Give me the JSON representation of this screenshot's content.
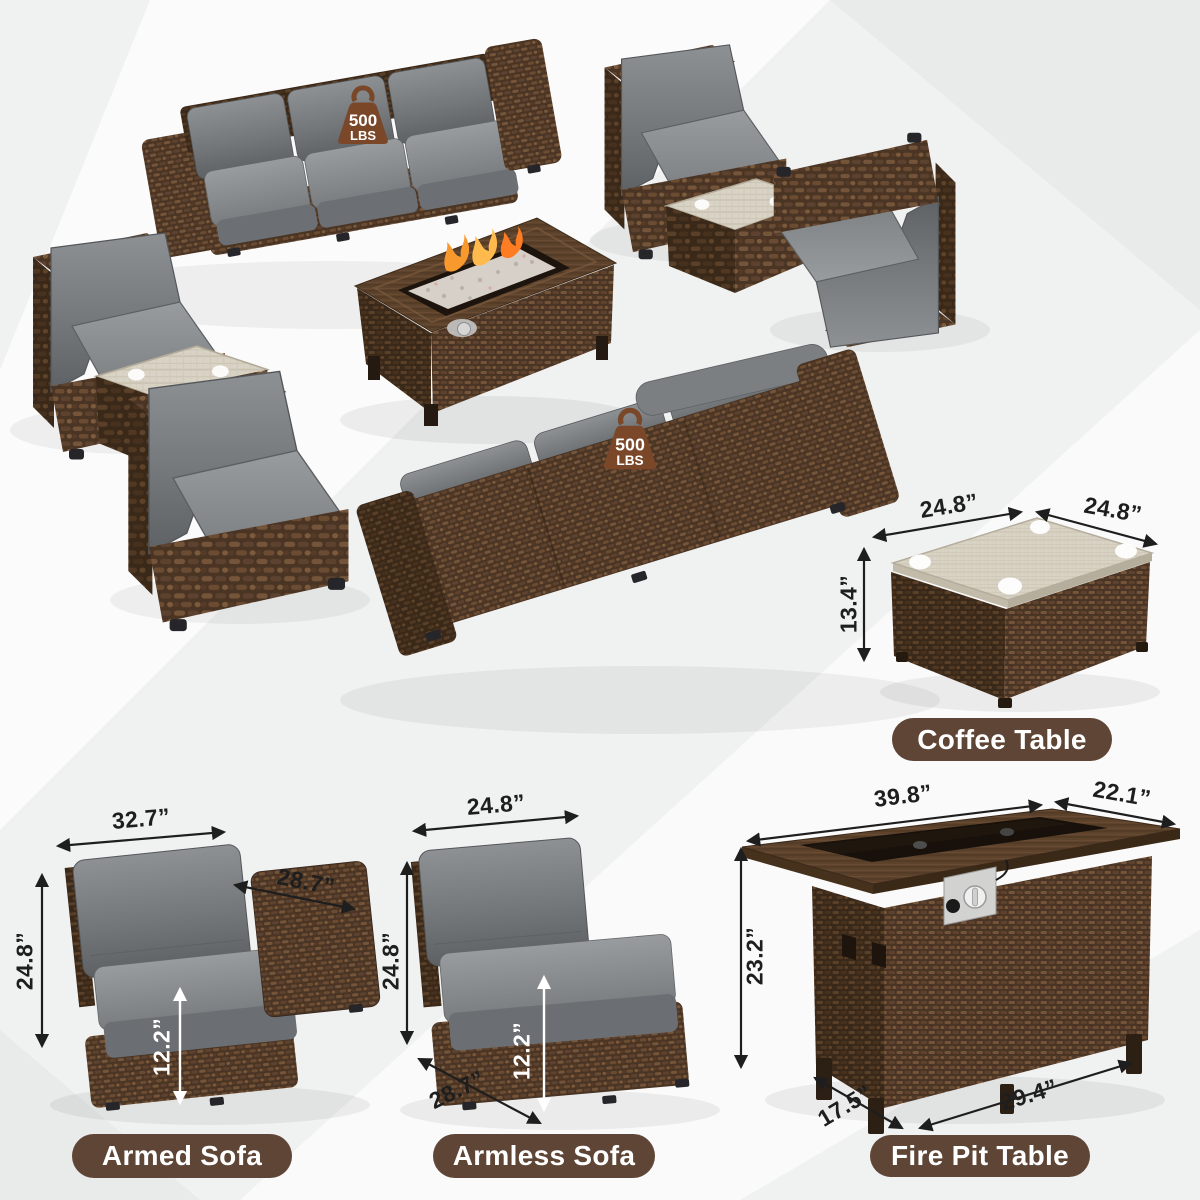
{
  "colors": {
    "label_pill": "#5e4536",
    "weight_badge": "#7a4729",
    "dimension_text": "#1e1e1e",
    "cushion_gray": "#797d80",
    "wicker_brown": "#5a4129"
  },
  "weight_badge": {
    "value": "500",
    "unit": "LBS"
  },
  "products": {
    "coffee_table": {
      "label": "Coffee Table",
      "dims": {
        "top_width": "24.8”",
        "top_depth": "24.8”",
        "height": "13.4”"
      }
    },
    "armed_sofa": {
      "label": "Armed Sofa",
      "dims": {
        "width": "32.7”",
        "arm_depth": "28.7”",
        "height": "24.8”",
        "seat_height": "12.2”"
      }
    },
    "armless_sofa": {
      "label": "Armless Sofa",
      "dims": {
        "width": "24.8”",
        "height": "24.8”",
        "depth": "28.7”",
        "seat_height": "12.2”"
      }
    },
    "fire_pit_table": {
      "label": "Fire Pit Table",
      "dims": {
        "top_width": "39.8”",
        "top_depth": "22.1”",
        "height": "23.2”",
        "base_depth": "17.5”",
        "base_width": "29.4”"
      }
    }
  }
}
